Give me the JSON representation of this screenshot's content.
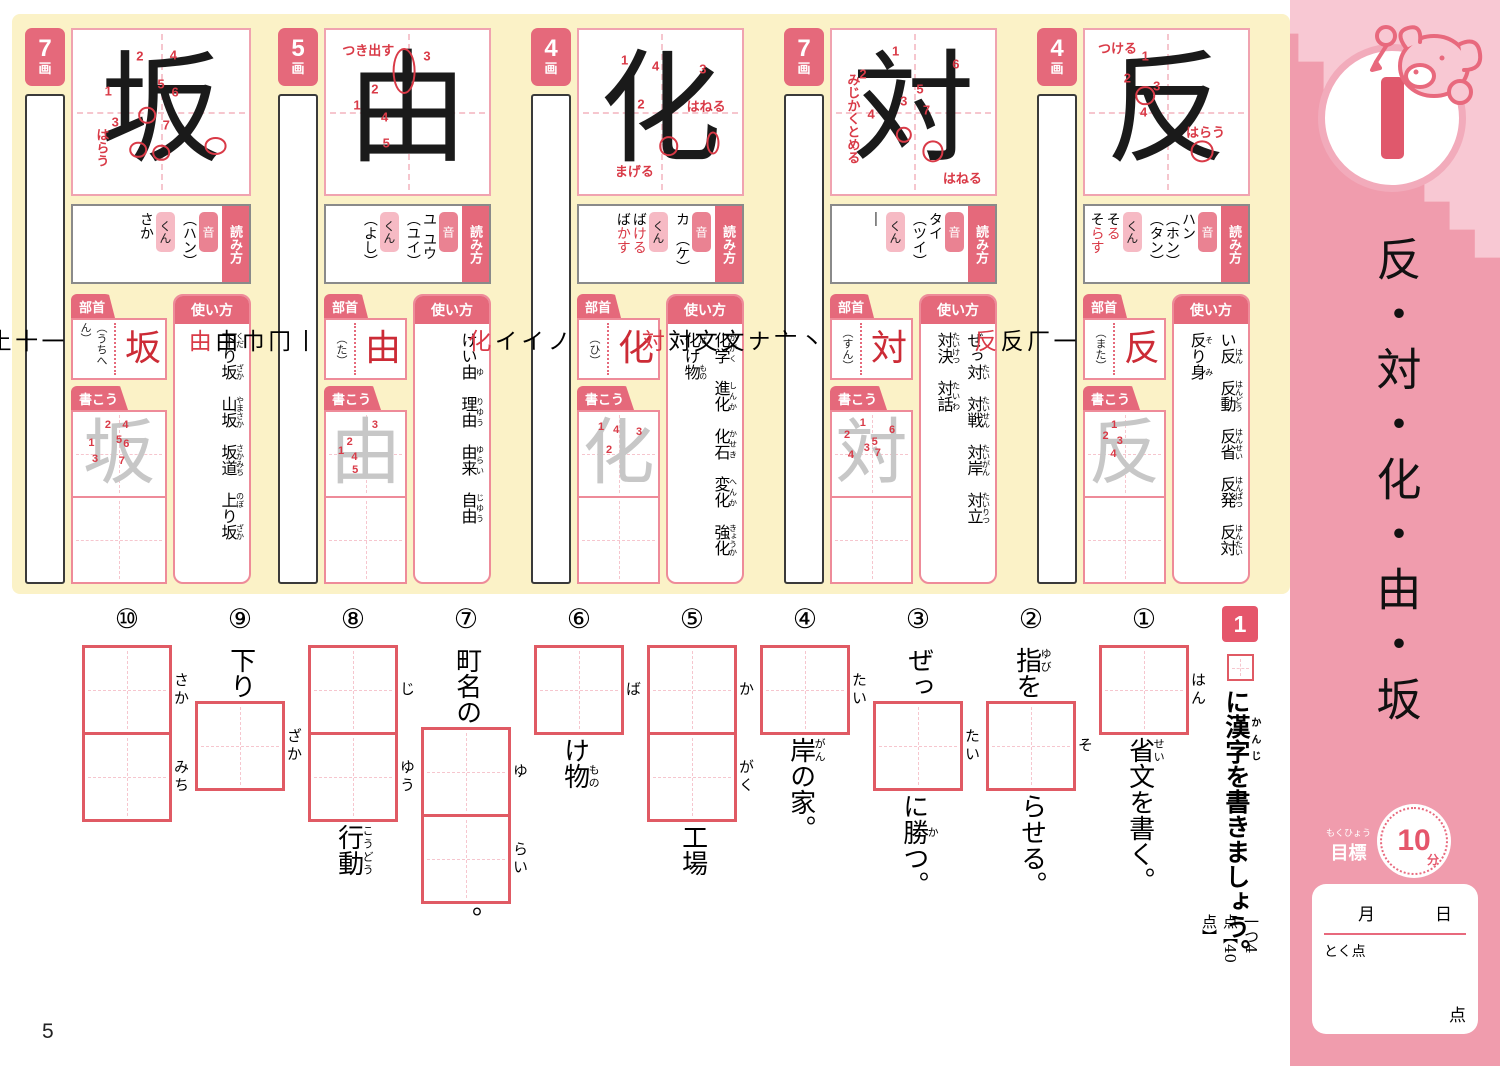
{
  "page": {
    "number": "5"
  },
  "colors": {
    "accent_pink": "#E5697B",
    "light_pink_tag": "#F6BAC4",
    "red_stroke": "#D93A47",
    "yellow_bg": "#FBF2C7",
    "sidebar_pink": "#F09CAD",
    "exercise_box_red": "#E05A64"
  },
  "labels": {
    "yomikata": "読み方",
    "on": "音",
    "kun": "くん",
    "bushu": "部首",
    "kakou": "書こう",
    "tsukaikata": "使い方",
    "kaku": "画"
  },
  "sidebar": {
    "lesson_number": "1",
    "title": "反・対・化・由・坂",
    "goal": {
      "label": "目標",
      "furigana": "もくひょう",
      "minutes": "10",
      "unit": "分"
    },
    "date": {
      "month": "月",
      "day": "日"
    },
    "score": {
      "label": "とく点",
      "unit": "点"
    }
  },
  "kanji": [
    {
      "char": "坂",
      "strokes": "7",
      "stroke_order": [
        "一",
        "十",
        "土",
        "坅",
        "坂",
        "坂",
        "坂"
      ],
      "readings_on": [
        "（ハン）"
      ],
      "readings_kun": [
        {
          "pre": "さか",
          "oku": ""
        }
      ],
      "radical_name": "（うちへん）",
      "usage": [
        [
          {
            "t": "下",
            "r": "くだ"
          },
          {
            "t": "り"
          },
          {
            "t": "坂",
            "r": "ざか"
          }
        ],
        [
          {
            "t": "山坂",
            "r": "やまさか"
          }
        ],
        [
          {
            "t": "坂道",
            "r": "さかみち"
          }
        ],
        [
          {
            "t": "上",
            "r": "のぼ"
          },
          {
            "t": "り"
          },
          {
            "t": "坂",
            "r": "ざか"
          }
        ]
      ],
      "numbers": [
        {
          "n": 1,
          "x": 20,
          "y": 37
        },
        {
          "n": 2,
          "x": 38,
          "y": 16
        },
        {
          "n": 3,
          "x": 24,
          "y": 56
        },
        {
          "n": 4,
          "x": 57,
          "y": 15
        },
        {
          "n": 5,
          "x": 50,
          "y": 33
        },
        {
          "n": 6,
          "x": 58,
          "y": 38
        },
        {
          "n": 7,
          "x": 53,
          "y": 58
        }
      ],
      "annotations": [
        {
          "text": "はらう",
          "x": 11,
          "y": 60,
          "vert": true
        }
      ],
      "circles": [
        {
          "x": 42,
          "y": 52,
          "w": 10,
          "h": 10
        },
        {
          "x": 37,
          "y": 73,
          "w": 10,
          "h": 10
        },
        {
          "x": 50,
          "y": 75,
          "w": 10,
          "h": 10
        },
        {
          "x": 81,
          "y": 71,
          "w": 13,
          "h": 11
        }
      ]
    },
    {
      "char": "由",
      "strokes": "5",
      "stroke_order": [
        "丨",
        "冂",
        "巾",
        "由",
        "由"
      ],
      "readings_on": [
        "ユ",
        "ユウ",
        "（ユイ）"
      ],
      "readings_kun": [
        {
          "pre": "（よし）",
          "oku": ""
        }
      ],
      "radical_name": "（た）",
      "usage": [
        [
          {
            "t": "けい"
          },
          {
            "t": "由",
            "r": "ゆ"
          }
        ],
        [
          {
            "t": "理由",
            "r": "りゆう"
          }
        ],
        [
          {
            "t": "由来",
            "r": "ゆらい"
          }
        ],
        [
          {
            "t": "自由",
            "r": "じゆう"
          }
        ]
      ],
      "numbers": [
        {
          "n": 3,
          "x": 62,
          "y": 16
        },
        {
          "n": 2,
          "x": 30,
          "y": 36
        },
        {
          "n": 1,
          "x": 19,
          "y": 46
        },
        {
          "n": 4,
          "x": 36,
          "y": 53
        },
        {
          "n": 5,
          "x": 37,
          "y": 69
        }
      ],
      "annotations": [
        {
          "text": "つき出す",
          "x": 10,
          "y": 6,
          "vert": false
        }
      ],
      "circles": [
        {
          "x": 48,
          "y": 25,
          "w": 14,
          "h": 28
        }
      ]
    },
    {
      "char": "化",
      "strokes": "4",
      "stroke_order": [
        "ノ",
        "イ",
        "イ",
        "化"
      ],
      "readings_on": [
        "カ",
        "（ケ）"
      ],
      "readings_kun": [
        {
          "pre": "ば",
          "oku": "ける"
        },
        {
          "pre": "ば",
          "oku": "かす"
        }
      ],
      "radical_name": "（ひ）",
      "usage": [
        [
          {
            "t": "化学",
            "r": "かがく"
          }
        ],
        [
          {
            "t": "進化",
            "r": "しんか"
          }
        ],
        [
          {
            "t": "化石",
            "r": "かせき"
          }
        ],
        [
          {
            "t": "変化",
            "r": "へんか"
          }
        ],
        [
          {
            "t": "強化",
            "r": "きょうか"
          }
        ],
        [
          {
            "t": "化",
            "r": "ば"
          },
          {
            "t": "け"
          },
          {
            "t": "物",
            "r": "もの"
          }
        ]
      ],
      "numbers": [
        {
          "n": 1,
          "x": 28,
          "y": 18
        },
        {
          "n": 4,
          "x": 47,
          "y": 22
        },
        {
          "n": 3,
          "x": 76,
          "y": 24
        },
        {
          "n": 2,
          "x": 38,
          "y": 45
        }
      ],
      "annotations": [
        {
          "text": "はねる",
          "x": 66,
          "y": 40,
          "vert": false
        },
        {
          "text": "まげる",
          "x": 22,
          "y": 80,
          "vert": false
        }
      ],
      "circles": [
        {
          "x": 55,
          "y": 71,
          "w": 12,
          "h": 12
        },
        {
          "x": 82,
          "y": 69,
          "w": 8,
          "h": 14
        }
      ]
    },
    {
      "char": "対",
      "strokes": "7",
      "stroke_order": [
        "丶",
        "亠",
        "ナ",
        "文",
        "文",
        "対",
        "対"
      ],
      "readings_on": [
        "タイ",
        "（ツイ）"
      ],
      "readings_kun": [
        {
          "pre": "―",
          "oku": ""
        }
      ],
      "radical_name": "（すん）",
      "usage": [
        [
          {
            "t": "ぜっ"
          },
          {
            "t": "対",
            "r": "たい"
          }
        ],
        [
          {
            "t": "対戦",
            "r": "たいせん"
          }
        ],
        [
          {
            "t": "対岸",
            "r": "たいがん"
          }
        ],
        [
          {
            "t": "対立",
            "r": "たいりつ"
          }
        ],
        [
          {
            "t": "対決",
            "r": "たいけつ"
          }
        ],
        [
          {
            "t": "対話",
            "r": "たいわ"
          }
        ]
      ],
      "numbers": [
        {
          "n": 1,
          "x": 39,
          "y": 13
        },
        {
          "n": 2,
          "x": 19,
          "y": 27
        },
        {
          "n": 6,
          "x": 76,
          "y": 21
        },
        {
          "n": 5,
          "x": 54,
          "y": 36
        },
        {
          "n": 3,
          "x": 44,
          "y": 43
        },
        {
          "n": 7,
          "x": 58,
          "y": 49
        },
        {
          "n": 4,
          "x": 24,
          "y": 51
        }
      ],
      "annotations": [
        {
          "text": "みじかくとめる",
          "x": 7,
          "y": 26,
          "vert": true
        },
        {
          "text": "はねる",
          "x": 68,
          "y": 84,
          "vert": false
        }
      ],
      "circles": [
        {
          "x": 44,
          "y": 64,
          "w": 10,
          "h": 10
        },
        {
          "x": 62,
          "y": 74,
          "w": 13,
          "h": 13
        }
      ]
    },
    {
      "char": "反",
      "strokes": "4",
      "stroke_order": [
        "一",
        "厂",
        "反",
        "反"
      ],
      "readings_on": [
        "ハン",
        "（ホン）",
        "（タン）"
      ],
      "readings_kun": [
        {
          "pre": "そ",
          "oku": "る"
        },
        {
          "pre": "そ",
          "oku": "らす"
        }
      ],
      "radical_name": "（また）",
      "usage": [
        [
          {
            "t": "い"
          },
          {
            "t": "反",
            "r": "はん"
          }
        ],
        [
          {
            "t": "反動",
            "r": "はんどう"
          }
        ],
        [
          {
            "t": "反省",
            "r": "はんせい"
          }
        ],
        [
          {
            "t": "反発",
            "r": "はんぱつ"
          }
        ],
        [
          {
            "t": "反対",
            "r": "はんたい"
          }
        ],
        [
          {
            "t": "反",
            "r": "そ"
          },
          {
            "t": "り"
          },
          {
            "t": "身",
            "r": "み"
          }
        ]
      ],
      "numbers": [
        {
          "n": 1,
          "x": 37,
          "y": 16
        },
        {
          "n": 2,
          "x": 26,
          "y": 29
        },
        {
          "n": 3,
          "x": 44,
          "y": 34
        },
        {
          "n": 4,
          "x": 36,
          "y": 50
        }
      ],
      "annotations": [
        {
          "text": "つける",
          "x": 8,
          "y": 5,
          "vert": false
        },
        {
          "text": "はらう",
          "x": 62,
          "y": 56,
          "vert": false
        }
      ],
      "circles": [
        {
          "x": 37,
          "y": 40,
          "w": 12,
          "h": 12
        },
        {
          "x": 72,
          "y": 74,
          "w": 14,
          "h": 13
        }
      ]
    }
  ],
  "exercise": {
    "number": "1",
    "instruction": [
      {
        "t": "に"
      },
      {
        "t": "漢字",
        "r": "かんじ"
      },
      {
        "t": "を書きましょう。"
      }
    ],
    "note": "一つ4点【40点】",
    "questions": [
      {
        "num": "①",
        "parts": [
          {
            "box": "はん"
          },
          {
            "text": [
              {
                "t": "省",
                "r": "せい"
              },
              {
                "t": "文を書く。"
              }
            ]
          }
        ]
      },
      {
        "num": "②",
        "parts": [
          {
            "text": [
              {
                "t": "指",
                "r": "ゆび"
              },
              {
                "t": "を"
              }
            ]
          },
          {
            "box": "そ"
          },
          {
            "text": [
              {
                "t": "らせる。"
              }
            ]
          }
        ]
      },
      {
        "num": "③",
        "parts": [
          {
            "text": [
              {
                "t": "ぜっ"
              }
            ]
          },
          {
            "box": "たい"
          },
          {
            "text": [
              {
                "t": "に"
              },
              {
                "t": "勝",
                "r": "か"
              },
              {
                "t": "つ。"
              }
            ]
          }
        ]
      },
      {
        "num": "④",
        "parts": [
          {
            "box": "たい"
          },
          {
            "text": [
              {
                "t": "岸",
                "r": "がん"
              },
              {
                "t": "の家。"
              }
            ]
          }
        ]
      },
      {
        "num": "⑤",
        "parts": [
          {
            "box": "か"
          },
          {
            "box": "がく",
            "joined": true
          },
          {
            "text": [
              {
                "t": "工場"
              }
            ]
          }
        ]
      },
      {
        "num": "⑥",
        "parts": [
          {
            "box": "ば"
          },
          {
            "text": [
              {
                "t": "け"
              },
              {
                "t": "物",
                "r": "もの"
              }
            ]
          }
        ]
      },
      {
        "num": "⑦",
        "parts": [
          {
            "text": [
              {
                "t": "町名の"
              }
            ]
          },
          {
            "box": "ゆ"
          },
          {
            "box": "らい",
            "joined": true
          },
          {
            "text": [
              {
                "t": "。"
              }
            ]
          }
        ]
      },
      {
        "num": "⑧",
        "parts": [
          {
            "box": "じ"
          },
          {
            "box": "ゆう",
            "joined": true
          },
          {
            "text": [
              {
                "t": "行動",
                "r": "こうどう"
              }
            ]
          }
        ]
      },
      {
        "num": "⑨",
        "parts": [
          {
            "text": [
              {
                "t": "下り"
              }
            ]
          },
          {
            "box": "ざか"
          }
        ]
      },
      {
        "num": "⑩",
        "parts": [
          {
            "box": "さか"
          },
          {
            "box": "みち",
            "joined": true
          }
        ]
      }
    ]
  }
}
